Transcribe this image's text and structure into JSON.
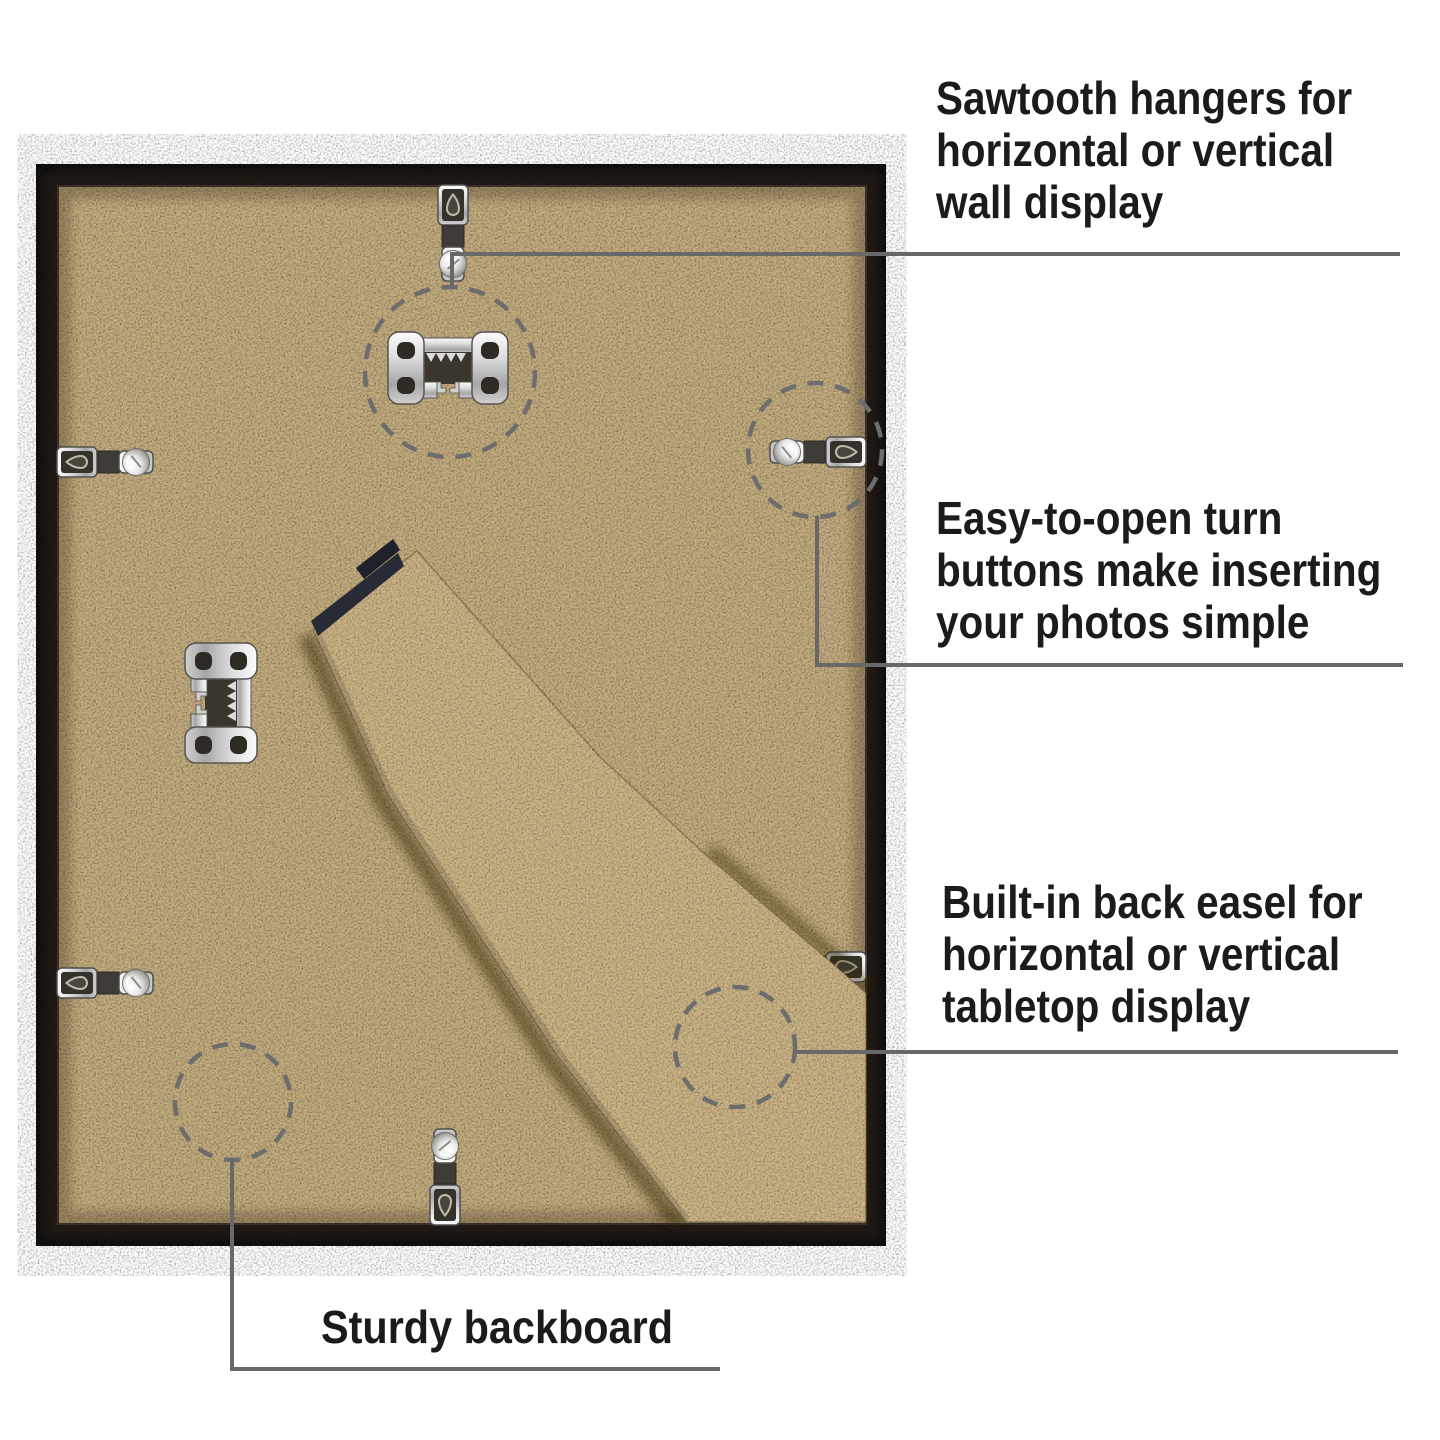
{
  "title": "Picture frame back — feature callout diagram",
  "colors": {
    "background": "#ffffff",
    "frame": "#121110",
    "backboard": "#c4ad7f",
    "easel": "#ccb486",
    "line": "#686868",
    "circle": "#6d6d6d",
    "text": "#1b1b1b",
    "hinge": "#272b36",
    "metal_edge": "#56544f",
    "hole": "#2e2b25"
  },
  "callouts": {
    "sawtooth": {
      "lines": [
        "Sawtooth hangers for",
        "horizontal or vertical",
        "wall display"
      ]
    },
    "turn_buttons": {
      "lines": [
        "Easy-to-open turn",
        "buttons make inserting",
        "your photos simple"
      ]
    },
    "easel": {
      "lines": [
        "Built-in back easel for",
        "horizontal or vertical",
        "tabletop display"
      ]
    },
    "backboard": {
      "lines": [
        "Sturdy backboard"
      ]
    }
  },
  "parts": {
    "frame": "black picture frame (back view)",
    "backboard": "MDF backboard",
    "easel": "fold-out easel stand",
    "sawtooth_hangers": 2,
    "turn_buttons": 6,
    "highlight_circles": 4
  }
}
